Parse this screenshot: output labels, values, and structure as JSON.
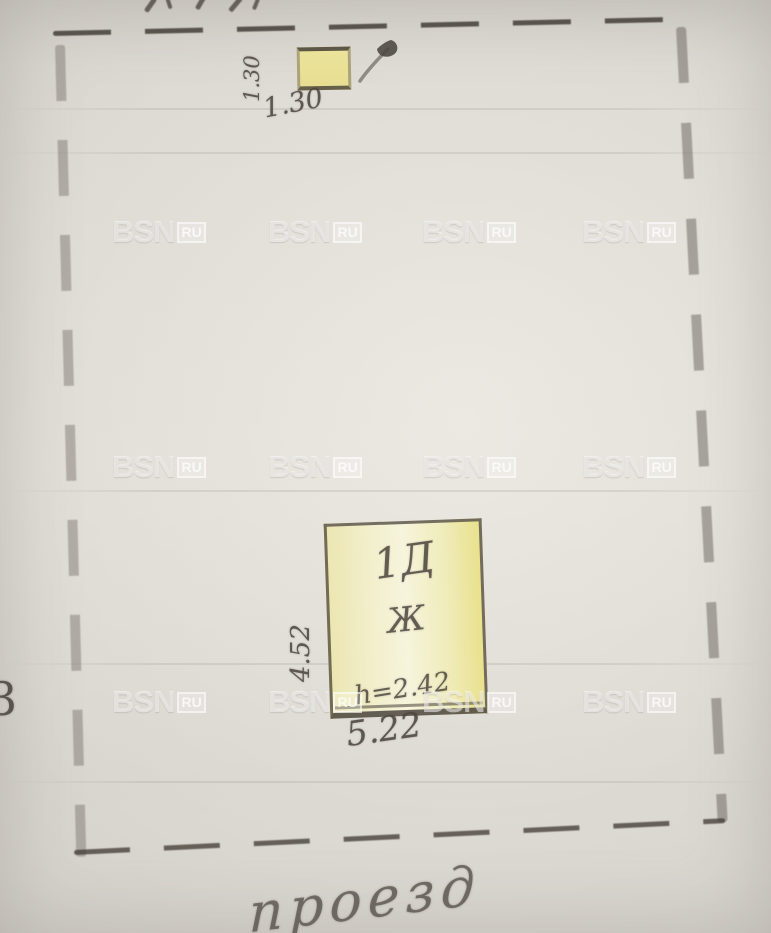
{
  "photo": {
    "description": "photograph of a hand-drawn site plan (pencil on paper)",
    "paper_color": "#dcd8d2",
    "pencil_color": "#55504a",
    "highlight_yellow": "#ece39b"
  },
  "watermark": {
    "brand": "BSN",
    "tld": "RU",
    "grid": {
      "cols": [
        112,
        268,
        422,
        582
      ],
      "rows": [
        214,
        449,
        684
      ]
    }
  },
  "plan": {
    "outbuilding": {
      "dim_left": "1.30",
      "dim_bottom": "1.30",
      "fill": "#e9e098"
    },
    "building": {
      "litera": "1Д",
      "letter": "Ж",
      "height_label": "h=2.42",
      "dim_bottom": "5.22",
      "dim_left": "4.52",
      "fill": "#f0ecbe"
    },
    "edge_mark_left": "3",
    "bottom_caption": "проезд"
  }
}
